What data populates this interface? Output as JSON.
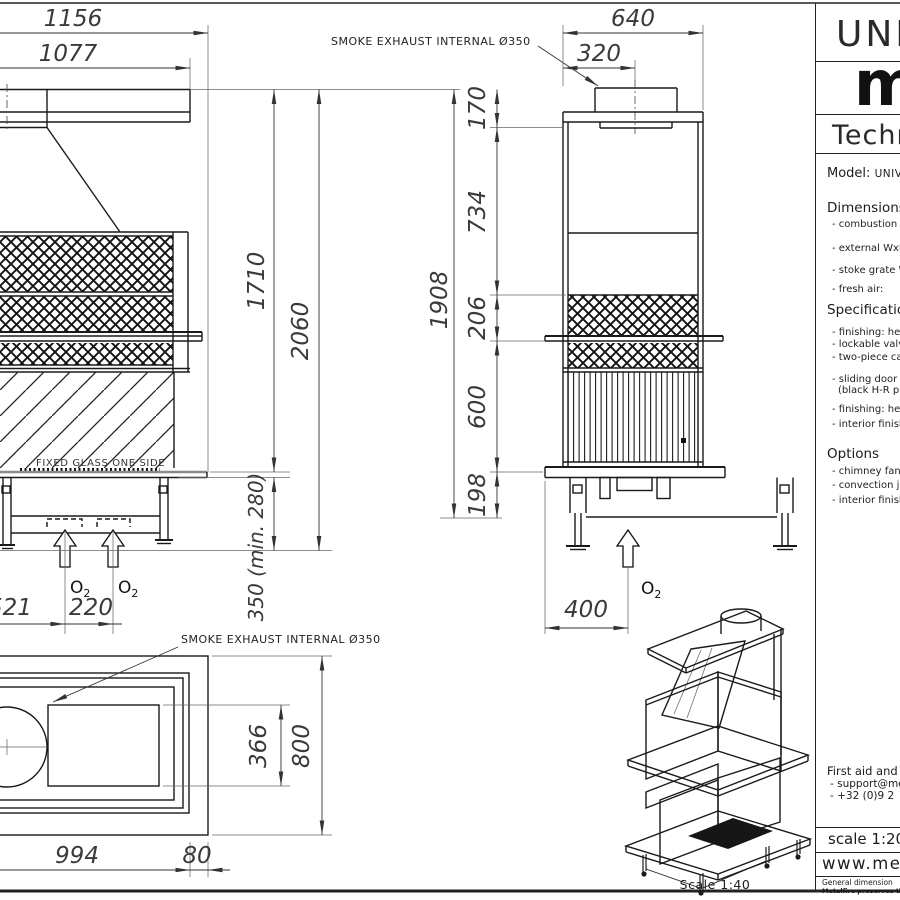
{
  "sheet": {
    "iso_scale_label": "Scale 1:40"
  },
  "labels": {
    "smoke_exhaust": "SMOKE EXHAUST INTERNAL Ø350",
    "fixed_glass": "FIXED GLASS ONE SIDE",
    "o2": "O",
    "o2_sub": "2"
  },
  "front_view": {
    "dims": {
      "total_width": "1156",
      "canopy_width": "1077",
      "body_height": "1710",
      "total_height": "2060",
      "leg_height": "350 (min. 280)",
      "intake_offset": "521",
      "intake_spacing": "220"
    }
  },
  "side_view": {
    "dims": {
      "total_depth": "640",
      "flue_center": "320",
      "flue_section": "170",
      "hood_section": "734",
      "grille_section": "206",
      "firebox_section": "600",
      "leg_section": "198",
      "total_height": "1908",
      "intake_depth": "400"
    }
  },
  "plan_view": {
    "dims": {
      "grate_depth": "366",
      "total_depth": "800",
      "body_width": "994",
      "back_offset": "80"
    }
  },
  "title_block": {
    "series": "UNIV",
    "logo": "m",
    "doc_type": "Techn",
    "model_label": "Model:",
    "model_value": "UNIV",
    "dimensions": {
      "heading": "Dimensions",
      "items": [
        "- combustion ch",
        "- external WxD",
        "- stoke grate W",
        "- fresh air:"
      ]
    },
    "specifications": {
      "heading": "Specification",
      "items": [
        "- finishing: hea",
        "- lockable valv",
        "- two-piece ca",
        "- sliding door i",
        "(black H-R p",
        "- finishing: hea",
        "- interior finishi"
      ]
    },
    "options": {
      "heading": "Options",
      "items": [
        "- chimney fan",
        "- convection ja",
        "- interior finishi"
      ]
    },
    "contact": {
      "heading": "First aid and",
      "items": [
        "- support@me",
        "- +32 (0)9 2"
      ]
    },
    "scale_row": "scale 1:20",
    "website": "www.met",
    "fine_print_1": "General dimension",
    "fine_print_2": "Metalfire preserves the ri"
  }
}
